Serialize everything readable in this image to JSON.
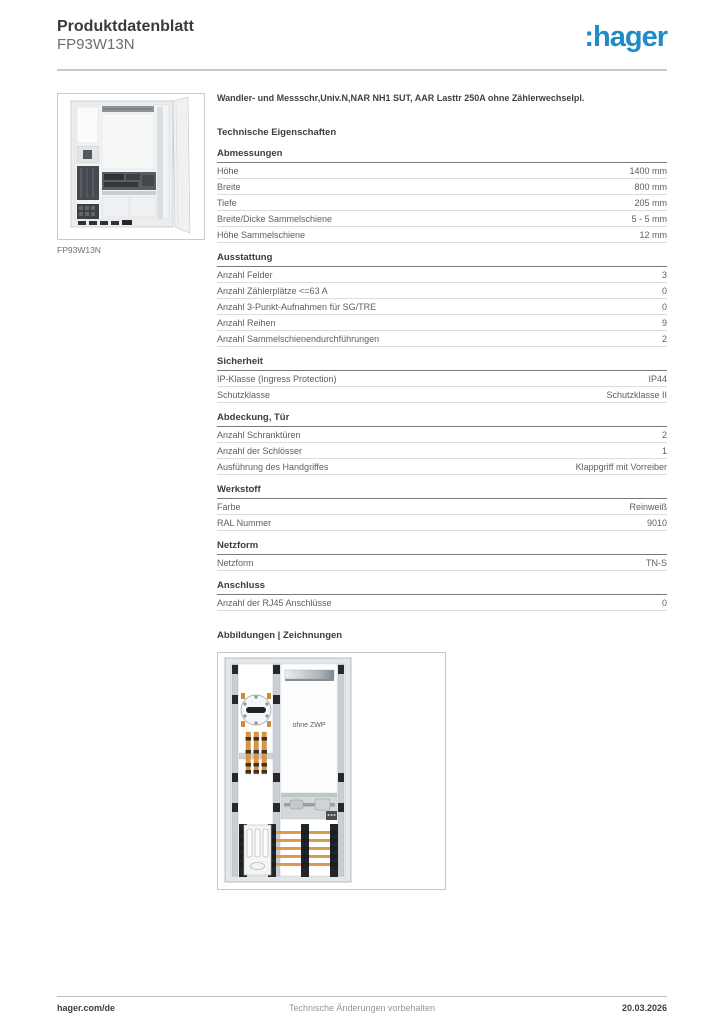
{
  "header": {
    "doc_type": "Produktdatenblatt",
    "product_ref": "FP93W13N",
    "logo_text": ":hager",
    "brand_color": "#1f8bc8"
  },
  "product": {
    "description": "Wandler- und Messschr,Univ.N,NAR NH1 SUT, AAR Lasttr 250A ohne Zählerwechselpl.",
    "image_caption": "FP93W13N"
  },
  "tech": {
    "title": "Technische Eigenschaften",
    "sections": [
      {
        "title": "Abmessungen",
        "rows": [
          {
            "label": "Höhe",
            "value": "1400 mm"
          },
          {
            "label": "Breite",
            "value": "800 mm"
          },
          {
            "label": "Tiefe",
            "value": "205 mm"
          },
          {
            "label": "Breite/Dicke Sammelschiene",
            "value": "5 - 5 mm"
          },
          {
            "label": "Höhe Sammelschiene",
            "value": "12 mm"
          }
        ]
      },
      {
        "title": "Ausstattung",
        "rows": [
          {
            "label": "Anzahl Felder",
            "value": "3"
          },
          {
            "label": "Anzahl Zählerplätze <=63 A",
            "value": "0"
          },
          {
            "label": "Anzahl 3-Punkt-Aufnahmen für SG/TRE",
            "value": "0"
          },
          {
            "label": "Anzahl Reihen",
            "value": "9"
          },
          {
            "label": "Anzahl Sammelschienendurchführungen",
            "value": "2"
          }
        ]
      },
      {
        "title": "Sicherheit",
        "rows": [
          {
            "label": "IP-Klasse (Ingress Protection)",
            "value": "IP44"
          },
          {
            "label": "Schutzklasse",
            "value": "Schutzklasse II"
          }
        ]
      },
      {
        "title": "Abdeckung, Tür",
        "rows": [
          {
            "label": "Anzahl Schranktüren",
            "value": "2"
          },
          {
            "label": "Anzahl der Schlösser",
            "value": "1"
          },
          {
            "label": "Ausführung des Handgriffes",
            "value": "Klappgriff mit Vorreiber"
          }
        ]
      },
      {
        "title": "Werkstoff",
        "rows": [
          {
            "label": "Farbe",
            "value": "Reinweiß"
          },
          {
            "label": "RAL Nummer",
            "value": "9010"
          }
        ]
      },
      {
        "title": "Netzform",
        "rows": [
          {
            "label": "Netzform",
            "value": "TN-S"
          }
        ]
      },
      {
        "title": "Anschluss",
        "rows": [
          {
            "label": "Anzahl der RJ45 Anschlüsse",
            "value": "0"
          }
        ]
      }
    ]
  },
  "drawings": {
    "title": "Abbildungen | Zeichnungen",
    "label": "ohne ZWP"
  },
  "footer": {
    "website": "hager.com/de",
    "notice": "Technische Änderungen vorbehalten",
    "date": "20.03.2026"
  }
}
